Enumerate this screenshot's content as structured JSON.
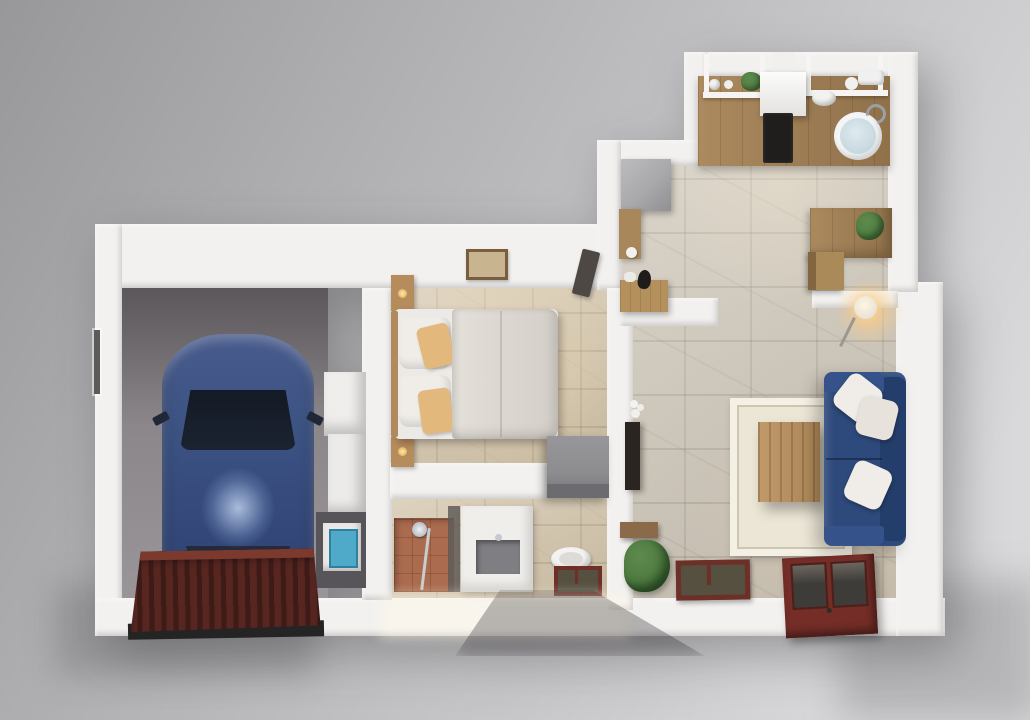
{
  "palette": {
    "bg_top": "#98979a",
    "bg_mid": "#c2c1c3",
    "bg_bottom": "#d9d8da",
    "wall": "#f2f1ef",
    "garage_floor": "#8a8588",
    "tile_beige": "#d5c6ab",
    "stone": "#ccc4b6",
    "wood": "#ab8a5f",
    "wood_dark": "#90714a",
    "car_body": "#3c5383",
    "car_glass": "#1c2330",
    "sofa": "#2e4a7c",
    "sofa_dark": "#243e6b",
    "sofa_light": "#35528a",
    "pillow": "#f0ede8",
    "cushion_tan": "#e3b87c",
    "garage_door": "#572621",
    "garage_door_rib": "#3f1b18",
    "garage_door_top": "#7c392e",
    "french_door": "#742d27",
    "door_glass": "#3e3c38",
    "window_frame": "#6e2f28",
    "window_glass": "#55503f",
    "rug": "#ece6d6",
    "rug_border": "#f4f0e4",
    "terracotta": "#aa6b4e",
    "gray_cabinet": "#8d8d90",
    "tv_dark": "#2a2520",
    "plant_green": "#4e7a41",
    "lamp_glow": "#ffcd85",
    "washer_blue": "#4fa9c9",
    "porcelain": "#f4f3f1",
    "counter_gray": "#7f7f83",
    "fridge_gray": "#a9a8ab",
    "duvet": "#ddd8d1"
  },
  "scene": {
    "view": "top-down 3d architectural render",
    "rooms": [
      {
        "name": "garage",
        "furniture": [
          "blue car",
          "ribbed garage door",
          "white shelving",
          "washing machine",
          "wall window slit"
        ]
      },
      {
        "name": "bedroom",
        "furniture": [
          "double bed",
          "white pillows",
          "tan cushions",
          "nightstand with lamp",
          "nightstand with lamp",
          "wall picture",
          "gray dresser",
          "open door"
        ]
      },
      {
        "name": "bathroom",
        "furniture": [
          "terracotta shower",
          "shower fixture",
          "glass partition",
          "white vanity",
          "gray basin",
          "toilet",
          "red framed window"
        ]
      },
      {
        "name": "kitchen",
        "furniture": [
          "wood counter",
          "black cooktop",
          "range hood",
          "round sink",
          "open shelves",
          "shelf plant",
          "bowls",
          "fridge",
          "tall cabinet",
          "entry bench",
          "dark figurine"
        ]
      },
      {
        "name": "dining nook",
        "furniture": [
          "wood desk",
          "chair",
          "potted plant",
          "glowing floor lamp"
        ]
      },
      {
        "name": "living room",
        "furniture": [
          "blue sofa",
          "white throw pillows",
          "cream rug",
          "wood coffee table",
          "wall tv",
          "white flowers",
          "wall shelf",
          "floor plant",
          "red framed window",
          "red french door"
        ]
      }
    ]
  }
}
